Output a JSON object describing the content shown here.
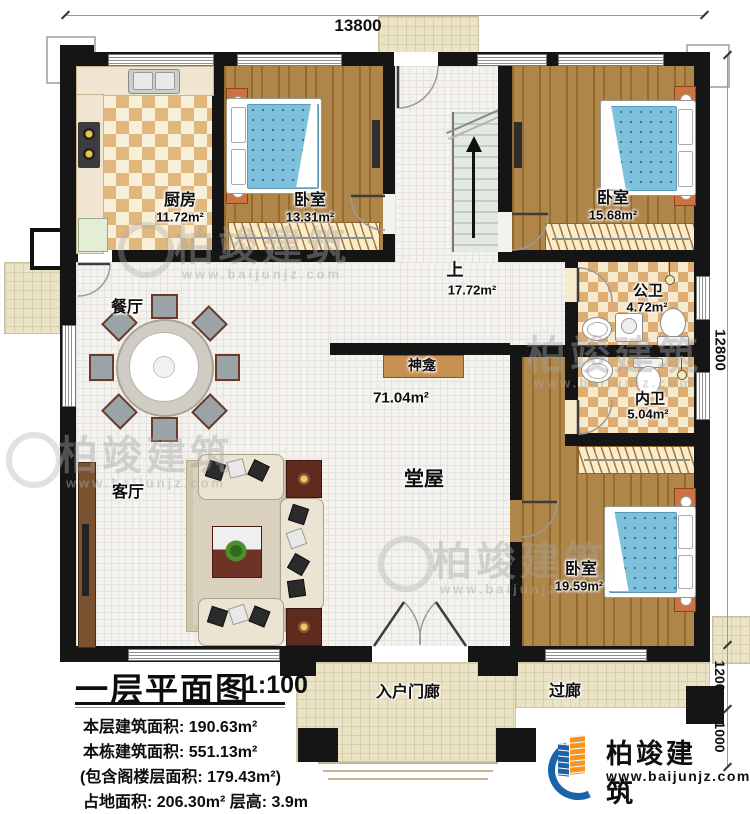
{
  "dimensions": {
    "top": "13800",
    "right_upper": "12800",
    "right_mid": "1200",
    "right_lower": "1000"
  },
  "rooms": {
    "kitchen": {
      "name": "厨房",
      "area": "11.72m²"
    },
    "bedroom1": {
      "name": "卧室",
      "area": "13.31m²"
    },
    "bedroom2": {
      "name": "卧室",
      "area": "15.68m²"
    },
    "stair": {
      "name": "上",
      "area": "17.72m²"
    },
    "dining": {
      "name": "餐厅"
    },
    "public_bath": {
      "name": "公卫",
      "area": "4.72m²"
    },
    "inner_bath": {
      "name": "内卫",
      "area": "5.04m²"
    },
    "shrine": {
      "name": "神龛"
    },
    "hall": {
      "name": "堂屋",
      "area": "71.04m²"
    },
    "living": {
      "name": "客厅"
    },
    "bedroom3": {
      "name": "卧室",
      "area": "19.59m²"
    },
    "entry_porch": {
      "name": "入户门廊"
    },
    "corridor": {
      "name": "过廊"
    }
  },
  "title_block": {
    "title": "一层平面图",
    "scale": "1:100",
    "lines": [
      "本层建筑面积: 190.63m²",
      "本栋建筑面积: 551.13m²",
      "(包含阁楼层面积: 179.43m²)",
      "占地面积: 206.30m²  层高: 3.9m"
    ]
  },
  "branding": {
    "company": "柏竣建筑",
    "website": "www.baijunjz.com"
  },
  "watermark": {
    "text": "柏竣建筑",
    "url": "www.baijunjz.com"
  },
  "colors": {
    "wall": "#151515",
    "wood_floor": "#a87d3f",
    "bed_blue": "#7ec1dc",
    "brand_blue": "#1b63a8",
    "brand_orange": "#f7941d"
  }
}
